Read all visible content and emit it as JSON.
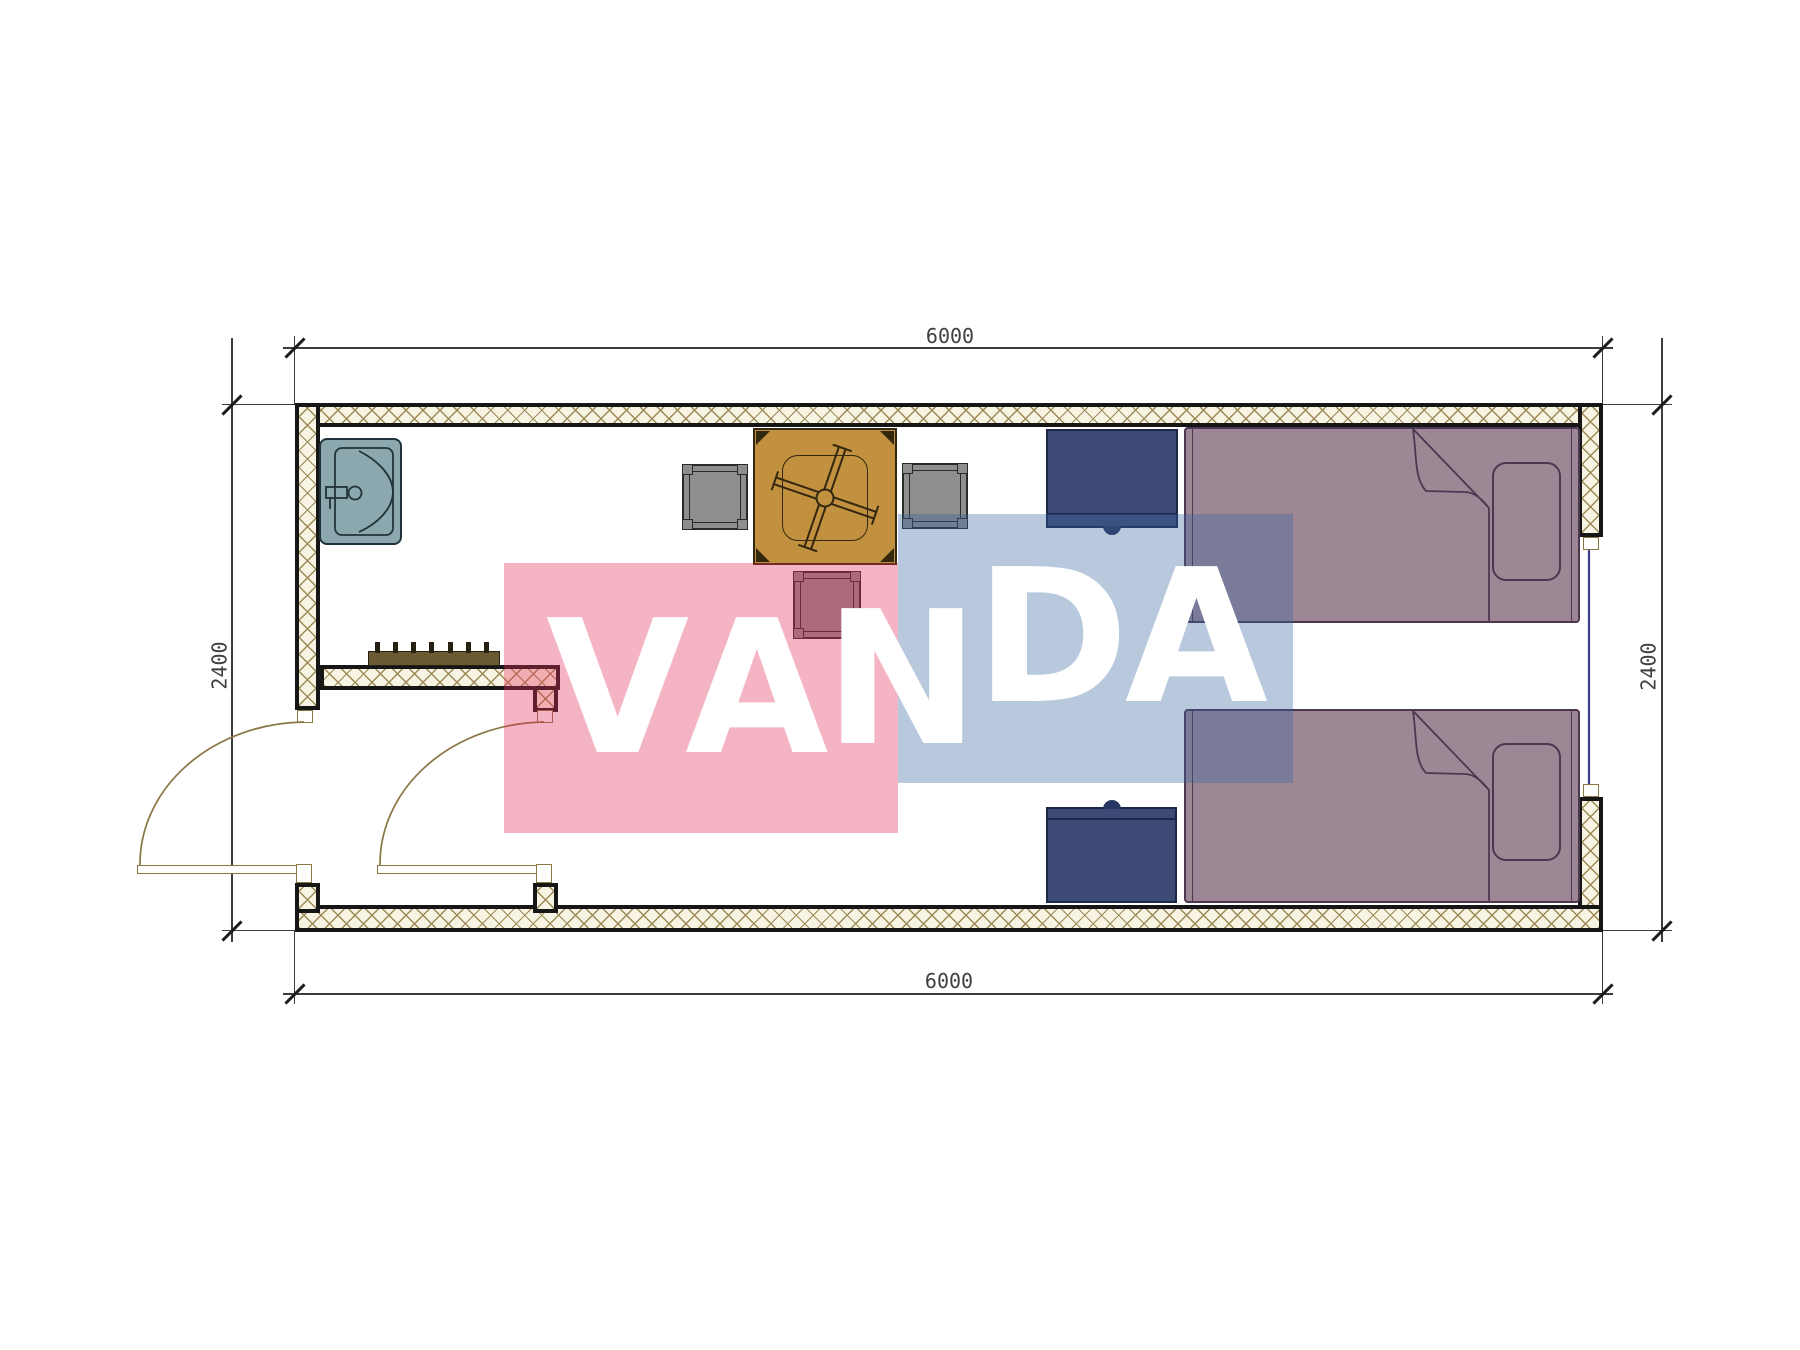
{
  "watermark": {
    "text": "VANDA",
    "letters": [
      "V",
      "A",
      "N",
      "D",
      "A"
    ]
  },
  "dimensions": {
    "top": "6000",
    "bottom": "6000",
    "left": "2400",
    "right": "2400"
  },
  "colors": {
    "background": "#ffffff",
    "wall_fill": "#f8f4e4",
    "wall_hatch": "#9b8a55",
    "wall_border": "#161616",
    "bed_fill": "#9d8795",
    "bed_line": "#4c3751",
    "nightstand_fill": "#3d4a76",
    "nightstand_line": "#1d2849",
    "nightstand_knob": "#2b3763",
    "table_fill": "#c29140",
    "table_line": "#33270e",
    "chair_fill": "#8e8e8e",
    "chair_line": "#2a2a2a",
    "sink_fill": "#8ba8af",
    "sink_line": "#21333a",
    "rack_fill": "#6b5a31",
    "rack_line": "#262013",
    "door_line": "#8a7544",
    "window_line": "#3c3c8e",
    "dim_color": "#3f3f3f",
    "watermark_pink": "rgba(226,48,88,0.36)",
    "watermark_blue": "rgba(55,100,158,0.35)",
    "watermark_text": "#ffffff"
  }
}
